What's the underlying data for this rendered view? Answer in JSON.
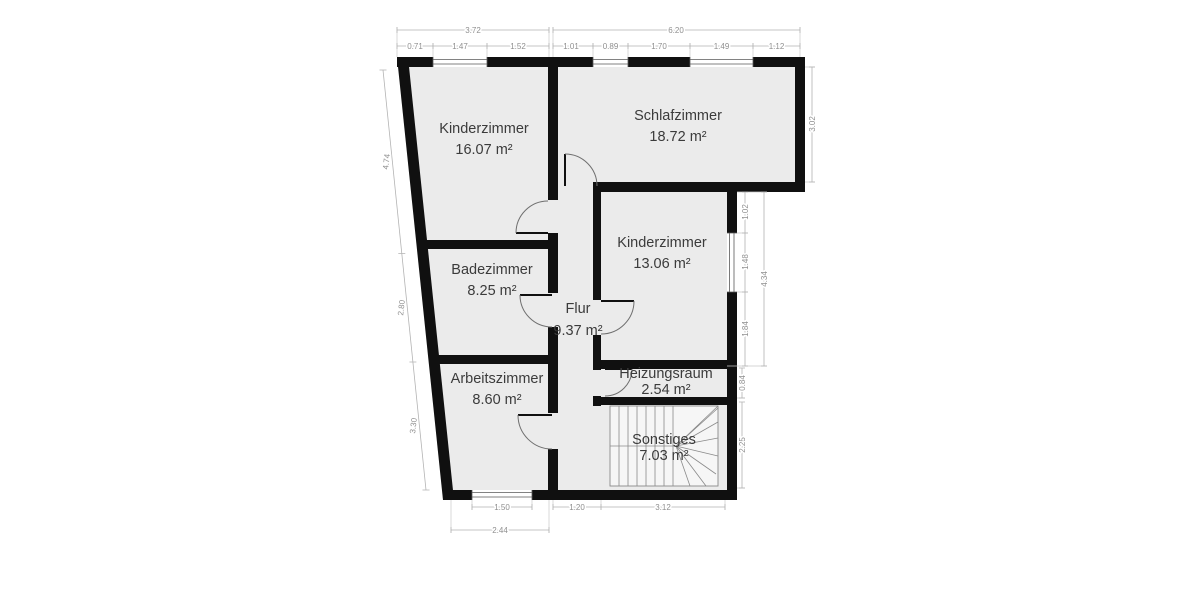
{
  "rooms": [
    {
      "id": "kinderzimmer-1",
      "name": "Kinderzimmer",
      "area": "16.07 m²"
    },
    {
      "id": "schlafzimmer",
      "name": "Schlafzimmer",
      "area": "18.72 m²"
    },
    {
      "id": "kinderzimmer-2",
      "name": "Kinderzimmer",
      "area": "13.06 m²"
    },
    {
      "id": "badezimmer",
      "name": "Badezimmer",
      "area": "8.25 m²"
    },
    {
      "id": "flur",
      "name": "Flur",
      "area": "9.37 m²"
    },
    {
      "id": "arbeitszimmer",
      "name": "Arbeitszimmer",
      "area": "8.60 m²"
    },
    {
      "id": "heizungsraum",
      "name": "Heizungsraum",
      "area": "2.54 m²"
    },
    {
      "id": "sonstiges",
      "name": "Sonstiges",
      "area": "7.03 m²"
    }
  ],
  "dimensions": {
    "top_primary": [
      "3.72",
      "6.20"
    ],
    "top_secondary": [
      "0.71",
      "1.47",
      "1.52",
      "1.01",
      "0.89",
      "1.70",
      "1.49",
      "1.12"
    ],
    "left_side": [
      "4.74",
      "2.80",
      "3.30"
    ],
    "right_side": [
      "3.02",
      "1.02",
      "1.48",
      "1.84",
      "4.34",
      "0.84",
      "2.25"
    ],
    "bottom": [
      "1.50",
      "1.20",
      "3.12",
      "2.44"
    ]
  },
  "colors": {
    "wall": "#101010",
    "floor_fill": "#ebebeb",
    "background": "#ffffff",
    "room_label": "#3b3b3b",
    "dimension_text": "#8f8f8f",
    "dimension_line": "#b3b3b3"
  }
}
